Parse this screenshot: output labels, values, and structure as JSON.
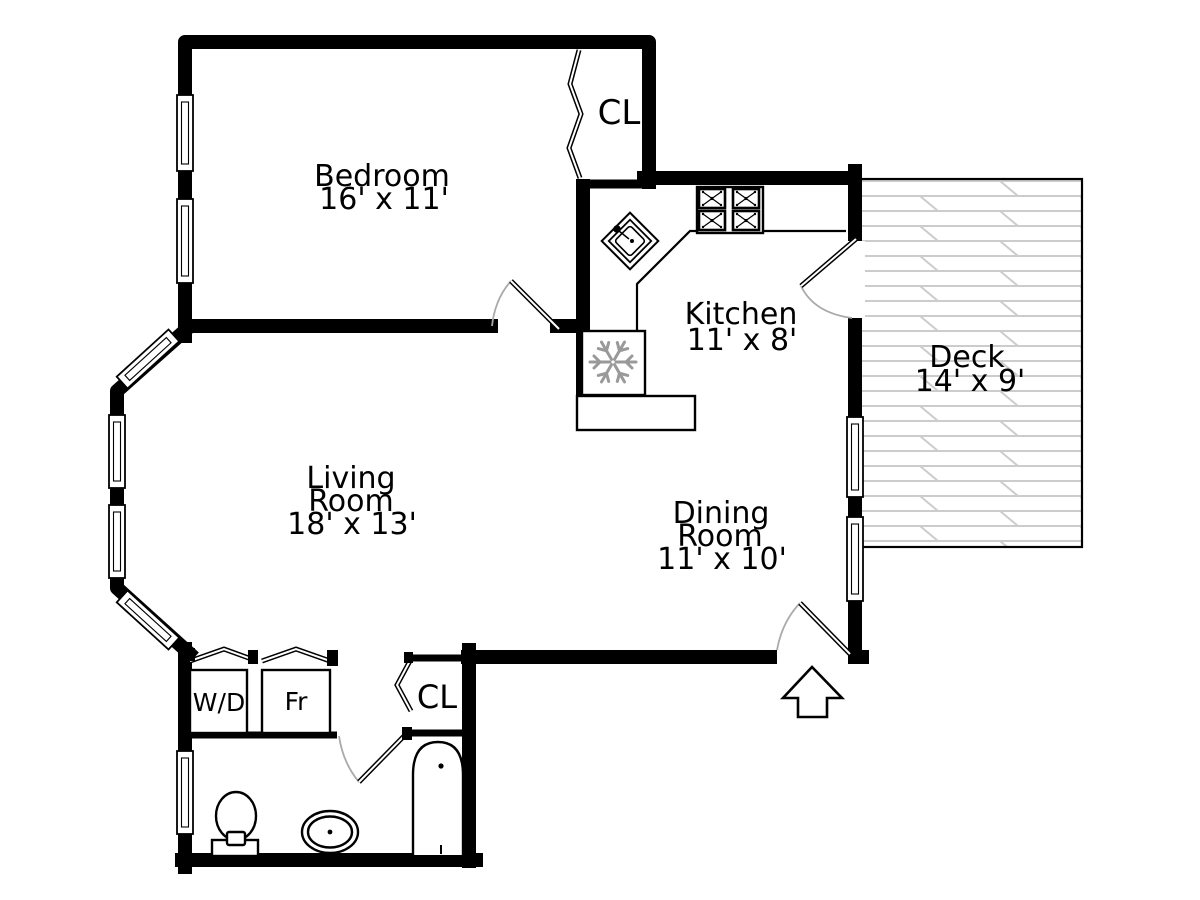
{
  "document": {
    "type": "residential floor plan"
  },
  "colors": {
    "background": "#ffffff",
    "wall": "#000000",
    "text": "#000000",
    "deck_plank": "#cccccc",
    "door_arc": "#aaaaaa",
    "snowflake": "#999999"
  },
  "rooms": {
    "bedroom": {
      "name": "Bedroom",
      "dimensions": "16' x 11'"
    },
    "closet_top": {
      "label": "CL"
    },
    "kitchen": {
      "name": "Kitchen",
      "dimensions": "11' x 8'"
    },
    "deck": {
      "name": "Deck",
      "dimensions": "14' x 9'"
    },
    "living_room": {
      "name_line1": "Living",
      "name_line2": "Room",
      "dimensions": "18' x 13'"
    },
    "dining_room": {
      "name_line1": "Dining",
      "name_line2": "Room",
      "dimensions": "11' x 10'"
    },
    "laundry": {
      "label": "W/D"
    },
    "pantry": {
      "label": "Fr"
    },
    "closet_bottom": {
      "label": "CL"
    }
  }
}
